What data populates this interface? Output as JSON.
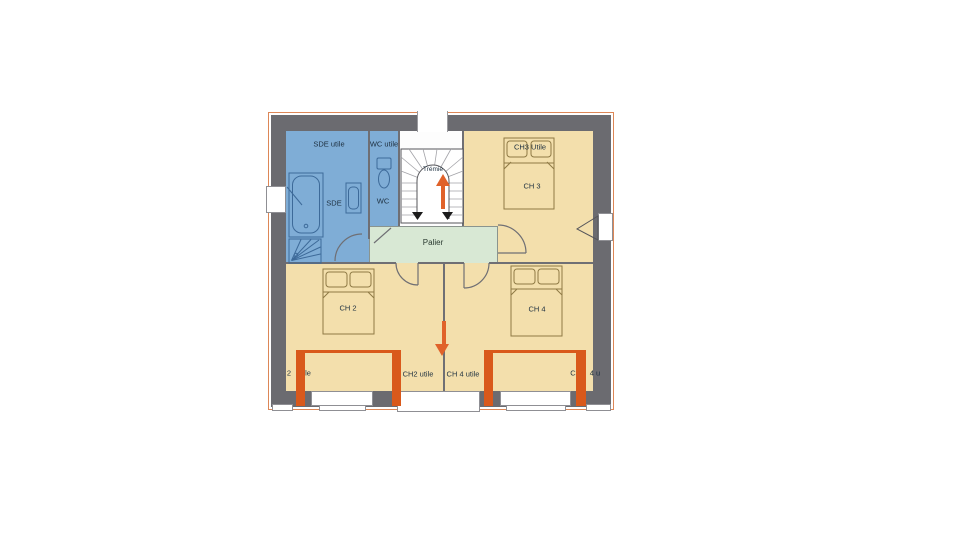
{
  "colors": {
    "blue": "#7fadd6",
    "beige": "#f3dfac",
    "green": "#d8e8d4",
    "wall": "#6b6b70",
    "dormer": "#d9591b",
    "arrow": "#e0622a",
    "boundary": "#dd8757"
  },
  "plan": {
    "labels": {
      "sde_area": "SDE utile",
      "wc_area": "WC utile",
      "sde": "SDE",
      "wc": "WC",
      "tremie": "Trémie",
      "palier": "Palier",
      "ch2": "CH 2",
      "ch3": "CH 3",
      "ch4": "CH 4",
      "ch3_area": "CH3 Utile",
      "ch2_area": "CH2 utile",
      "ch4_area": "CH 4 utile",
      "left_edge_partial_1": "2",
      "left_edge_partial_2": "le",
      "right_edge_partial_1": "C",
      "right_edge_partial_2": "4 u"
    }
  }
}
